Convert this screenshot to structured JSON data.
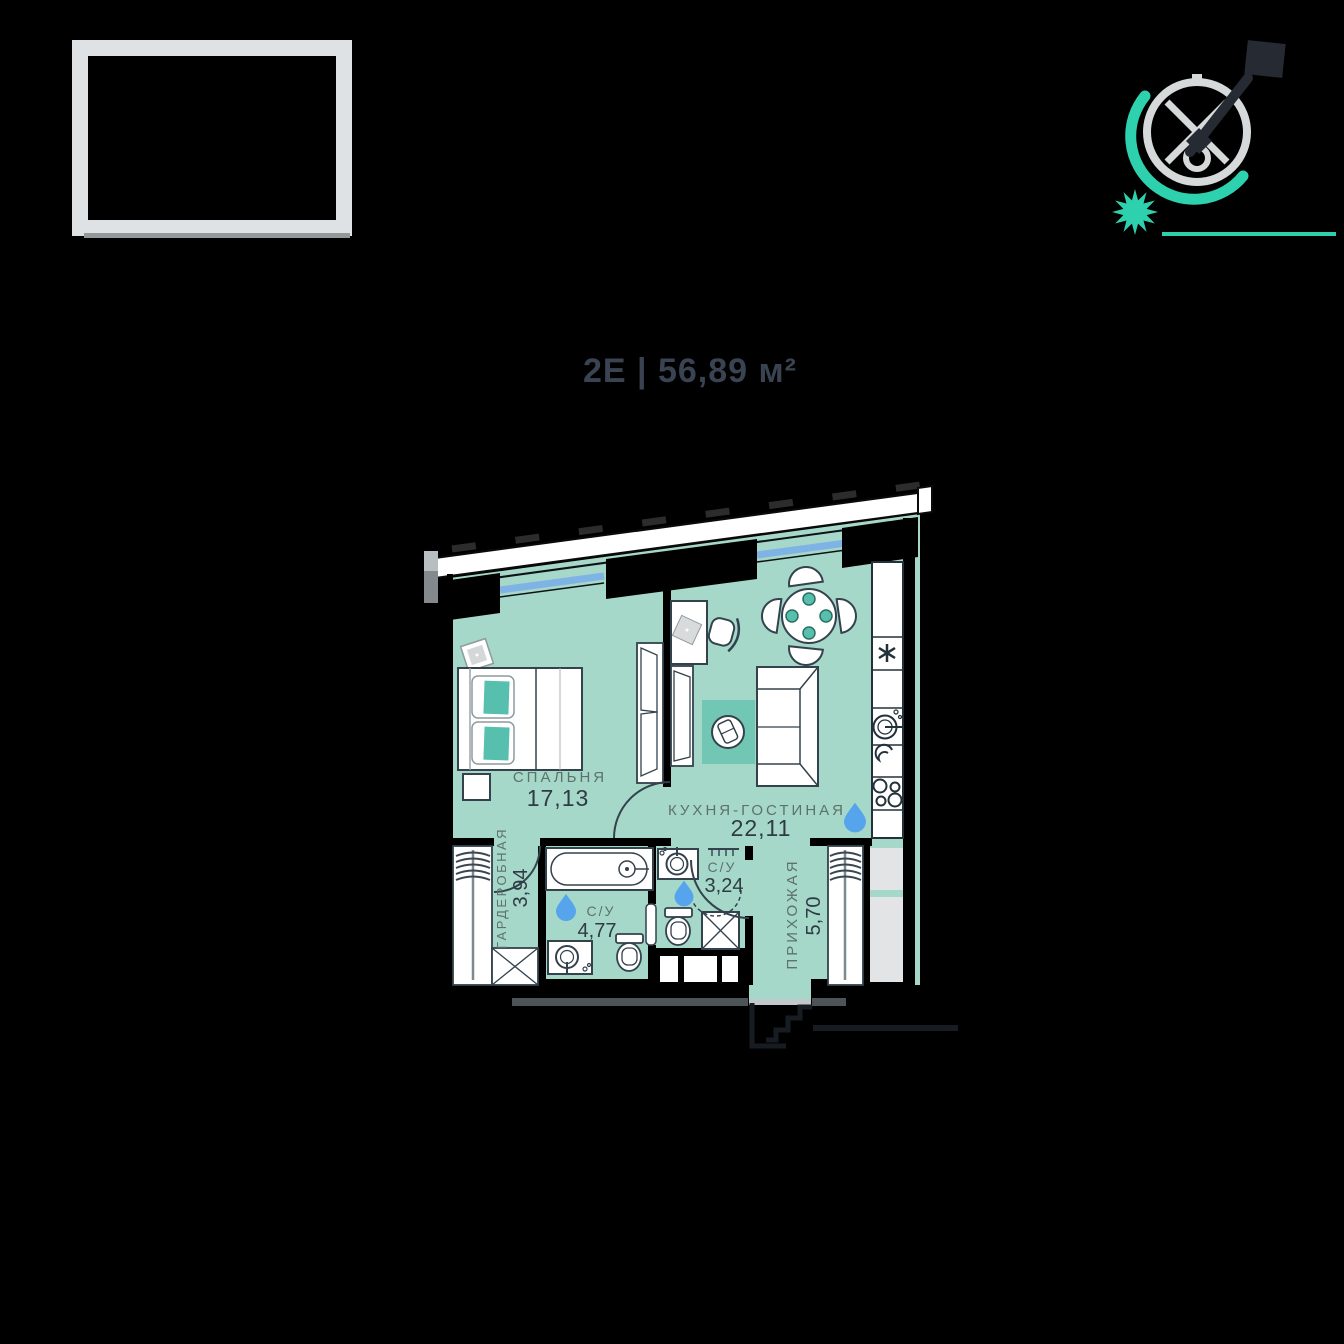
{
  "header": {
    "plan_title": "2Е | 56,89 м²"
  },
  "plan": {
    "rooms": [
      {
        "name": "СПАЛЬНЯ",
        "area": "17,13"
      },
      {
        "name": "КУХНЯ-ГОСТИНАЯ",
        "area": "22,11"
      },
      {
        "name": "ГАРДЕРОБНАЯ",
        "area": "3,94"
      },
      {
        "name": "С/У",
        "area": "4,77"
      },
      {
        "name": "С/У",
        "area": "3,24"
      },
      {
        "name": "ПРИХОЖАЯ",
        "area": "5,70"
      }
    ],
    "total_area": "56,89"
  },
  "icons": {
    "compass": "compass-icon",
    "north_flag": "north-flag-icon",
    "sun": "sun-icon",
    "water_drop": "water-drop-icon",
    "fridge": "fridge-asterisk-icon",
    "entry": "entry-door-icon"
  },
  "palette": {
    "background": "#000000",
    "floor": "#a5d8c8",
    "accent_teal": "#57bfae",
    "rug_teal": "#72c6b4",
    "window_blue": "#7fb3e6",
    "water_blue": "#55a4ec",
    "outline_dark": "#33424c",
    "compass_teal": "#2ed1ae",
    "compass_gray": "#d6d9da",
    "needle_dark": "#262b33",
    "label_gray": "#5e716c",
    "number_dark": "#2f3b44",
    "title_dark": "#3a4352",
    "frame_gray": "#dfe2e4"
  }
}
